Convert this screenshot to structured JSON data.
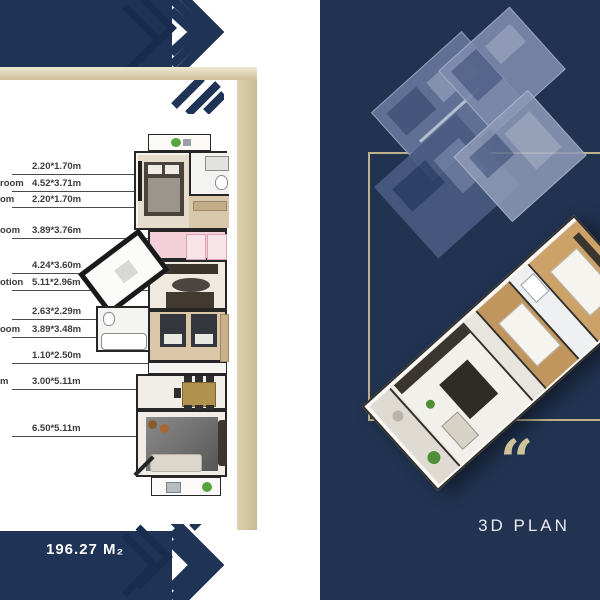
{
  "brand_colors": {
    "navy": "#1e3356",
    "gold_band": "#d5c9a4",
    "panel_navy": "#213351",
    "gold_frame": "#bfb28b",
    "quote_gold": "#cfc198",
    "dimension_text": "#3b3b3b"
  },
  "left_page": {
    "area_label": "196.27 M₂",
    "dimension_rows": [
      {
        "label": "",
        "value": "2.20*1.70m",
        "y": 174,
        "end": 188
      },
      {
        "label": "room",
        "value": "4.52*3.71m",
        "y": 191,
        "end": 163
      },
      {
        "label": "om",
        "value": "2.20*1.70m",
        "y": 207,
        "end": 186
      },
      {
        "label": "oom",
        "value": "3.89*3.76m",
        "y": 238,
        "end": 173
      },
      {
        "label": "",
        "value": "4.24*3.60m",
        "y": 273,
        "end": 118
      },
      {
        "label": "otion",
        "value": "5.11*2.96m",
        "y": 290,
        "end": 205
      },
      {
        "label": "",
        "value": "2.63*2.29m",
        "y": 319,
        "end": 138
      },
      {
        "label": "oom",
        "value": "3.89*3.48m",
        "y": 337,
        "end": 198
      },
      {
        "label": "",
        "value": "1.10*2.50m",
        "y": 363,
        "end": 152
      },
      {
        "label": "m",
        "value": "3.00*5.11m",
        "y": 389,
        "end": 173
      },
      {
        "label": "",
        "value": "6.50*5.11m",
        "y": 436,
        "end": 150
      }
    ]
  },
  "right_page": {
    "quote_glyph": "“",
    "caption": "3D PLAN"
  }
}
